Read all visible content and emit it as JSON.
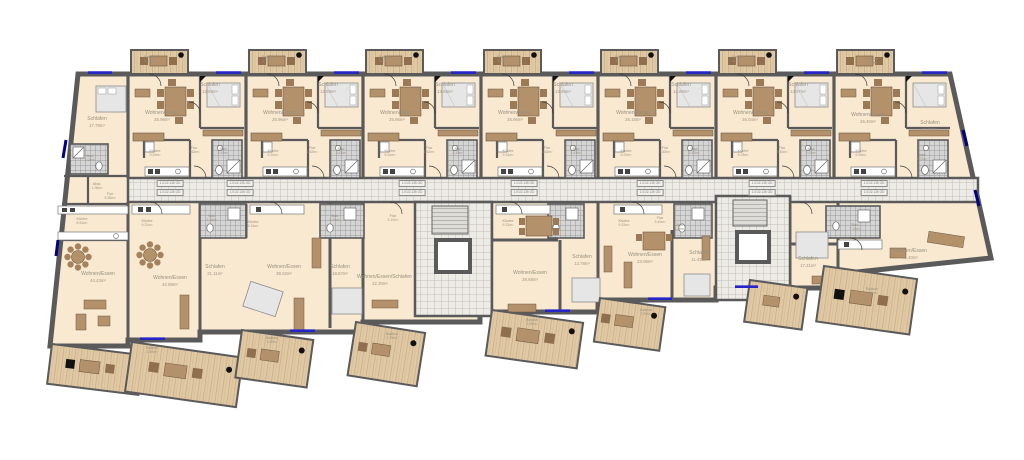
{
  "plan": {
    "door_tag_text": "1.01/2.135 OD",
    "door_tag_positions": [
      {
        "x": 170,
        "y": 180
      },
      {
        "x": 240,
        "y": 180
      },
      {
        "x": 412,
        "y": 180
      },
      {
        "x": 524,
        "y": 180
      },
      {
        "x": 650,
        "y": 180
      },
      {
        "x": 762,
        "y": 180
      },
      {
        "x": 874,
        "y": 180
      }
    ],
    "rooms": [
      {
        "label": "Schlafen",
        "area": "17.78m²",
        "x": 97,
        "y": 122
      },
      {
        "label": "Bad",
        "area": "4.05m²",
        "x": 90,
        "y": 158,
        "s": 1
      },
      {
        "label": "Abst.",
        "area": "1.96m²",
        "x": 97,
        "y": 186,
        "s": 1
      },
      {
        "label": "Flur",
        "area": "5.58m²",
        "x": 110,
        "y": 196,
        "s": 1
      },
      {
        "label": "Küche",
        "area": "8.51m²",
        "x": 82,
        "y": 221,
        "s": 1
      },
      {
        "label": "Wohnen/Essen",
        "area": "44.43m²",
        "x": 98,
        "y": 277
      },
      {
        "label": "Balkon",
        "area": "3.59m²",
        "x": 152,
        "y": 350,
        "s": 1
      },
      {
        "label": "Wohnen/Essen",
        "area": "25.96m²",
        "x": 162,
        "y": 116
      },
      {
        "label": "Schlafen",
        "area": "13.69m²",
        "x": 210,
        "y": 88
      },
      {
        "label": "Küche",
        "area": "9.31m²",
        "x": 155,
        "y": 153,
        "s": 1
      },
      {
        "label": "Flur",
        "area": "3.62m²",
        "x": 194,
        "y": 150,
        "s": 1
      },
      {
        "label": "Bad",
        "area": "3.43m²",
        "x": 223,
        "y": 151,
        "s": 1
      },
      {
        "label": "Balkon",
        "area": "2.76m²",
        "x": 150,
        "y": 59,
        "s": 1
      },
      {
        "label": "Wohnen/Essen",
        "area": "25.96m²",
        "x": 280,
        "y": 116
      },
      {
        "label": "Schlafen",
        "area": "13.69m²",
        "x": 328,
        "y": 88
      },
      {
        "label": "Küche",
        "area": "9.31m²",
        "x": 273,
        "y": 153,
        "s": 1
      },
      {
        "label": "Flur",
        "area": "3.62m²",
        "x": 312,
        "y": 150,
        "s": 1
      },
      {
        "label": "Bad",
        "area": "3.43m²",
        "x": 341,
        "y": 151,
        "s": 1
      },
      {
        "label": "Balkon",
        "area": "2.76m²",
        "x": 268,
        "y": 59,
        "s": 1
      },
      {
        "label": "Wohnen/Essen",
        "area": "25.96m²",
        "x": 397,
        "y": 116
      },
      {
        "label": "Schlafen",
        "area": "13.69m²",
        "x": 445,
        "y": 88
      },
      {
        "label": "Küche",
        "area": "9.31m²",
        "x": 390,
        "y": 153,
        "s": 1
      },
      {
        "label": "Flur",
        "area": "3.62m²",
        "x": 429,
        "y": 150,
        "s": 1
      },
      {
        "label": "Bad",
        "area": "3.43m²",
        "x": 458,
        "y": 151,
        "s": 1
      },
      {
        "label": "Balkon",
        "area": "2.76m²",
        "x": 385,
        "y": 59,
        "s": 1
      },
      {
        "label": "Wohnen/Essen",
        "area": "25.96m²",
        "x": 515,
        "y": 116
      },
      {
        "label": "Schlafen",
        "area": "13.69m²",
        "x": 563,
        "y": 88
      },
      {
        "label": "Küche",
        "area": "9.31m²",
        "x": 508,
        "y": 153,
        "s": 1
      },
      {
        "label": "Flur",
        "area": "3.62m²",
        "x": 547,
        "y": 150,
        "s": 1
      },
      {
        "label": "Bad",
        "area": "3.43m²",
        "x": 576,
        "y": 151,
        "s": 1
      },
      {
        "label": "Balkon",
        "area": "2.76m²",
        "x": 503,
        "y": 59,
        "s": 1
      },
      {
        "label": "Wohnen/Essen",
        "area": "26.15m²",
        "x": 633,
        "y": 116
      },
      {
        "label": "Schlafen",
        "area": "13.69m²",
        "x": 681,
        "y": 88
      },
      {
        "label": "Küche",
        "area": "9.31m²",
        "x": 626,
        "y": 153,
        "s": 1
      },
      {
        "label": "Flur",
        "area": "3.62m²",
        "x": 665,
        "y": 150,
        "s": 1
      },
      {
        "label": "Bad",
        "area": "3.43m²",
        "x": 694,
        "y": 151,
        "s": 1
      },
      {
        "label": "Balkon",
        "area": "2.76m²",
        "x": 621,
        "y": 59,
        "s": 1
      },
      {
        "label": "Wohnen/Essen",
        "area": "26.04m²",
        "x": 750,
        "y": 116
      },
      {
        "label": "Schlafen",
        "area": "13.57m²",
        "x": 798,
        "y": 88
      },
      {
        "label": "Küche",
        "area": "9.23m²",
        "x": 743,
        "y": 153,
        "s": 1
      },
      {
        "label": "Flur",
        "area": "3.40m²",
        "x": 782,
        "y": 150,
        "s": 1
      },
      {
        "label": "Bad",
        "area": "3.43m²",
        "x": 811,
        "y": 151,
        "s": 1
      },
      {
        "label": "Balkon",
        "area": "2.76m²",
        "x": 738,
        "y": 59,
        "s": 1
      },
      {
        "label": "Wohnen/Essen",
        "area": "26.40m²",
        "x": 868,
        "y": 118
      },
      {
        "label": "Schlafen",
        "area": "14.58m²",
        "x": 930,
        "y": 126
      },
      {
        "label": "Küche",
        "area": "9.53m²",
        "x": 861,
        "y": 153,
        "s": 1
      },
      {
        "label": "Bad",
        "area": "4.21m²",
        "x": 922,
        "y": 157,
        "s": 1
      },
      {
        "label": "Balkon",
        "area": "2.76m²",
        "x": 872,
        "y": 61,
        "s": 1
      },
      {
        "label": "Küche",
        "area": "9.31m²",
        "x": 147,
        "y": 223,
        "s": 1
      },
      {
        "label": "Wohnen/Essen",
        "area": "42.88m²",
        "x": 170,
        "y": 281
      },
      {
        "label": "Bad",
        "area": "4.06m²",
        "x": 212,
        "y": 218,
        "s": 1
      },
      {
        "label": "Küche",
        "area": "9.31m²",
        "x": 253,
        "y": 224,
        "s": 1
      },
      {
        "label": "Schlafen",
        "area": "21.11m²",
        "x": 215,
        "y": 270
      },
      {
        "label": "Wohnen/Essen",
        "area": "38.02m²",
        "x": 284,
        "y": 270
      },
      {
        "label": "Balkon",
        "area": "3.59m²",
        "x": 272,
        "y": 340,
        "s": 1
      },
      {
        "label": "Bad",
        "area": "5.49m²",
        "x": 335,
        "y": 218,
        "s": 1
      },
      {
        "label": "Flur",
        "area": "3.10m²",
        "x": 393,
        "y": 218,
        "s": 1
      },
      {
        "label": "Schlafen",
        "area": "18.67m²",
        "x": 340,
        "y": 270
      },
      {
        "label": "Wohnen/Essen/Schlafen",
        "area": "22.30m²",
        "x": 380,
        "y": 280,
        "w": 1
      },
      {
        "label": "Balkon",
        "area": "2.76m²",
        "x": 392,
        "y": 336,
        "s": 1
      },
      {
        "label": "Küche",
        "area": "9.31m²",
        "x": 508,
        "y": 223,
        "s": 1
      },
      {
        "label": "Wohnen/Essen",
        "area": "28.68m²",
        "x": 530,
        "y": 276
      },
      {
        "label": "Schlafen",
        "area": "13.78m²",
        "x": 582,
        "y": 260
      },
      {
        "label": "Balkon",
        "area": "3.59m²",
        "x": 532,
        "y": 322,
        "s": 1
      },
      {
        "label": "Küche",
        "area": "9.31m²",
        "x": 624,
        "y": 223,
        "s": 1
      },
      {
        "label": "Flur",
        "area": "3.40m²",
        "x": 660,
        "y": 220,
        "s": 1
      },
      {
        "label": "Bad",
        "area": "5.49m²",
        "x": 680,
        "y": 227,
        "s": 1
      },
      {
        "label": "Wohnen/Essen",
        "area": "23.06m²",
        "x": 645,
        "y": 258
      },
      {
        "label": "Schlafen",
        "area": "11.43m²",
        "x": 699,
        "y": 256
      },
      {
        "label": "Balkon",
        "area": "3.59m²",
        "x": 646,
        "y": 312,
        "s": 1
      },
      {
        "label": "Schlafen",
        "area": "17.21m²",
        "x": 808,
        "y": 262
      },
      {
        "label": "Bad",
        "area": "7.19m²",
        "x": 855,
        "y": 227,
        "s": 1
      },
      {
        "label": "Wohnen/Essen",
        "area": "41.40m²",
        "x": 910,
        "y": 254
      },
      {
        "label": "Balkon",
        "area": "3.59m²",
        "x": 872,
        "y": 291,
        "s": 1
      }
    ]
  }
}
